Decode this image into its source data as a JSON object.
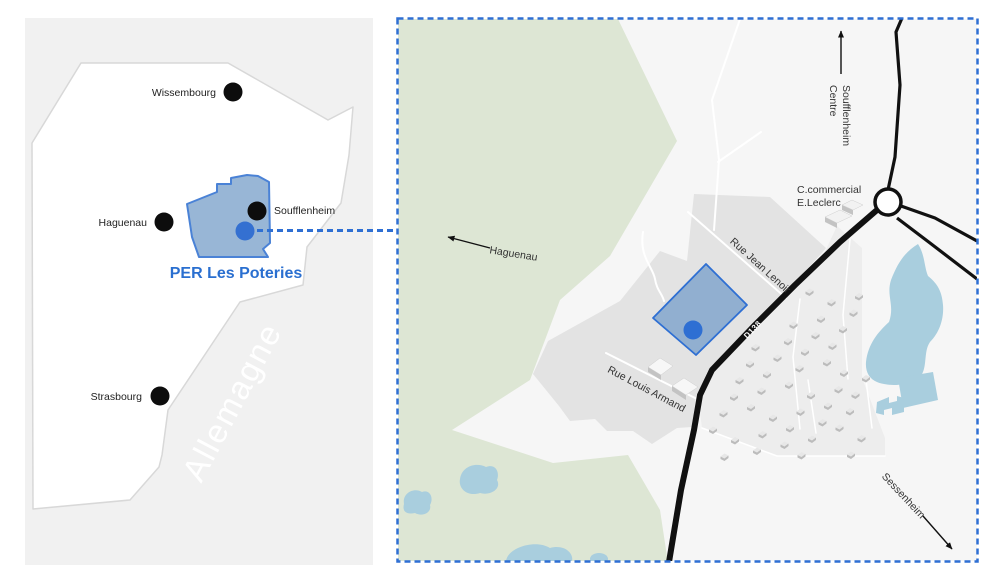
{
  "figure": {
    "description": "Location maps of PER Les Poteries near Soufflenheim (Alsace)"
  },
  "overview_map": {
    "cities": [
      {
        "name": "Wissembourg"
      },
      {
        "name": "Haguenau"
      },
      {
        "name": "Soufflenheim"
      },
      {
        "name": "Strasbourg"
      }
    ],
    "region_label": "PER Les Poteries",
    "country_label": "Allemagne"
  },
  "detail_map": {
    "streets": {
      "rue_jean_lenoir": "Rue Jean Lenoir",
      "rue_louis_armand": "Rue Louis Armand",
      "d138": "D138"
    },
    "directions": {
      "soufflenheim_line1": "Soufflenheim",
      "soufflenheim_line2": "Centre",
      "haguenau": "Haguenau",
      "sessenheim": "Sessenheim"
    },
    "poi": {
      "line1": "C.commercial",
      "line2": "E.Leclerc"
    },
    "housing_grid": {
      "origin": [
        300,
        200
      ],
      "row_step": [
        20,
        9.5
      ],
      "col_step": [
        -8.5,
        16.5
      ],
      "rows": 12,
      "cols": 14
    },
    "road_left_edge": [
      [
        444,
        225
      ],
      [
        399,
        268
      ],
      [
        359,
        308
      ],
      [
        316,
        353
      ],
      [
        304,
        378
      ],
      [
        298,
        413
      ],
      [
        285,
        473
      ]
    ]
  },
  "colors": {
    "accent_blue": "#2e6fd3",
    "site_fill": "#8caccf",
    "forest_green": "#dde6d4",
    "water_blue": "#a9cede",
    "urban_gray": "#e3e3e3",
    "housing_gray": "#ededed",
    "panel_gray": "#f1f1f1",
    "road_black": "#111111"
  }
}
